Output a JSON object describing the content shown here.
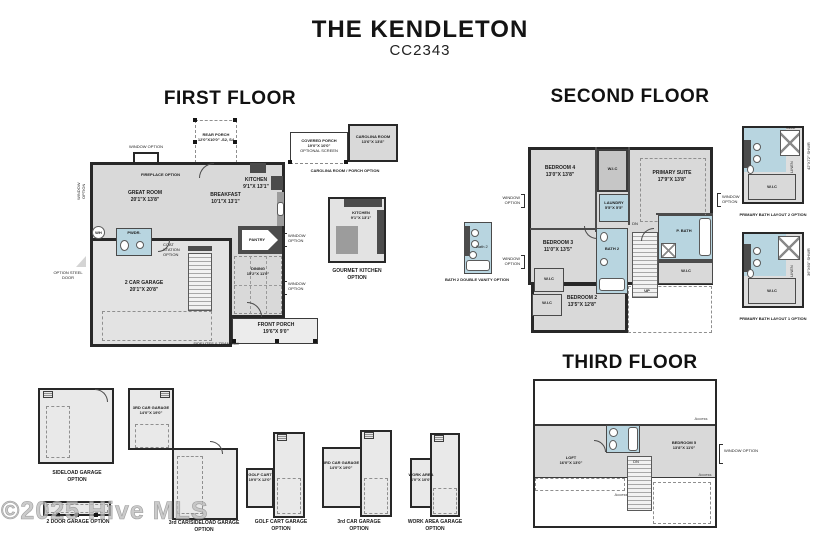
{
  "header": {
    "title": "THE KENDLETON",
    "subtitle": "CC2343"
  },
  "watermark": "©2025 Hive MLS",
  "common": {
    "window_option": "WINDOW OPTION",
    "wic": "W.I.C",
    "up": "UP",
    "dn": "DN",
    "access": "Access",
    "seat": "SEAT",
    "linen": "LINEN"
  },
  "first_floor": {
    "heading": "FIRST FLOOR",
    "rear_porch": {
      "name": "REAR PORCH",
      "dims": "12'0\"X10'0\" -S2, S4"
    },
    "great_room": {
      "name": "GREAT ROOM",
      "dims": "20'1\"X 13'8\""
    },
    "breakfast": {
      "name": "BREAKFAST",
      "dims": "10'1\"X 13'1\""
    },
    "kitchen": {
      "name": "KITCHEN",
      "dims": "9'1\"X 13'1\""
    },
    "garage": {
      "name": "2 CAR GARAGE",
      "dims": "20'1\"X 20'8\""
    },
    "dining": {
      "name": "DINING",
      "dims": "15'2\"X 11'0\""
    },
    "front_porch": {
      "name": "FRONT PORCH",
      "dims": "19'6\"X 9'0\""
    },
    "pantry": "PANTRY",
    "pwdr": "PWDR.",
    "wh": "WH",
    "fireplace_option": "FIREPLACE OPTION",
    "coat_station": "COAT STATION OPTION",
    "steel_door": "OPTION STEEL DOOR",
    "sidelites": "SIDELITES & TRANSOM",
    "covered_porch": {
      "name": "COVERED PORCH",
      "dims": "19'0\"X 10'0\"",
      "note": "OPTIONAL SCREEN"
    },
    "carolina_room": {
      "name": "CAROLINA ROOM",
      "dims": "13'6\"X 13'8\""
    },
    "carolina_caption": "CAROLINA ROOM / PORCH OPTION",
    "gourmet_caption": "GOURMET KITCHEN OPTION"
  },
  "second_floor": {
    "heading": "SECOND FLOOR",
    "bedroom4": {
      "name": "BEDROOM 4",
      "dims": "13'0\"X 13'8\""
    },
    "primary_suite": {
      "name": "PRIMARY SUITE",
      "dims": "17'9\"X 13'8\""
    },
    "laundry": {
      "name": "LAUNDRY",
      "dims": "5'5\"X 5'5\""
    },
    "bedroom3": {
      "name": "BEDROOM 3",
      "dims": "11'0\"X 13'5\""
    },
    "bedroom2": {
      "name": "BEDROOM 2",
      "dims": "13'5\"X 12'8\""
    },
    "bath2": "BATH 2",
    "p_bath": "P. BATH",
    "bath2_vanity_label": "Bath 2",
    "bath2_vanity_caption": "BATH 2 DOUBLE VANITY OPTION",
    "layout2_caption": "PRIMARY BATH LAYOUT 2 OPTION",
    "layout1_caption": "PRIMARY BATH LAYOUT 1 OPTION",
    "shwr2": "42\"X72\" SHWR",
    "shwr1": "36\"X60\" SHWR"
  },
  "third_floor": {
    "heading": "THIRD FLOOR",
    "loft": {
      "name": "LOFT",
      "dims": "16'0\"X 13'0\""
    },
    "bedroom5": {
      "name": "BEDROOM 5",
      "dims": "13'8\"X 11'0\""
    }
  },
  "garage_options": {
    "sideload_caption": "SIDELOAD GARAGE OPTION",
    "two_door_caption": "2 DOOR GARAGE OPTION",
    "third_sideload": {
      "name": "3RD CAR GARAGE",
      "dims": "14'0\"X 19'0\""
    },
    "third_sideload_caption": "3rd CAR/SIDELOAD GARAGE OPTION",
    "golf_cart": {
      "name": "GOLF CART",
      "dims": "19'0\"X 12'0\""
    },
    "golf_cart_caption": "GOLF CART GARAGE OPTION",
    "third_car": {
      "name": "3RD CAR GARAGE",
      "dims": "14'0\"X 19'0\""
    },
    "third_car_caption": "3rd CAR GARAGE OPTION",
    "work_area": {
      "name": "WORK AREA",
      "dims": "6'0\"X 10'0\""
    },
    "work_area_caption": "WORK AREA GARAGE OPTION"
  }
}
